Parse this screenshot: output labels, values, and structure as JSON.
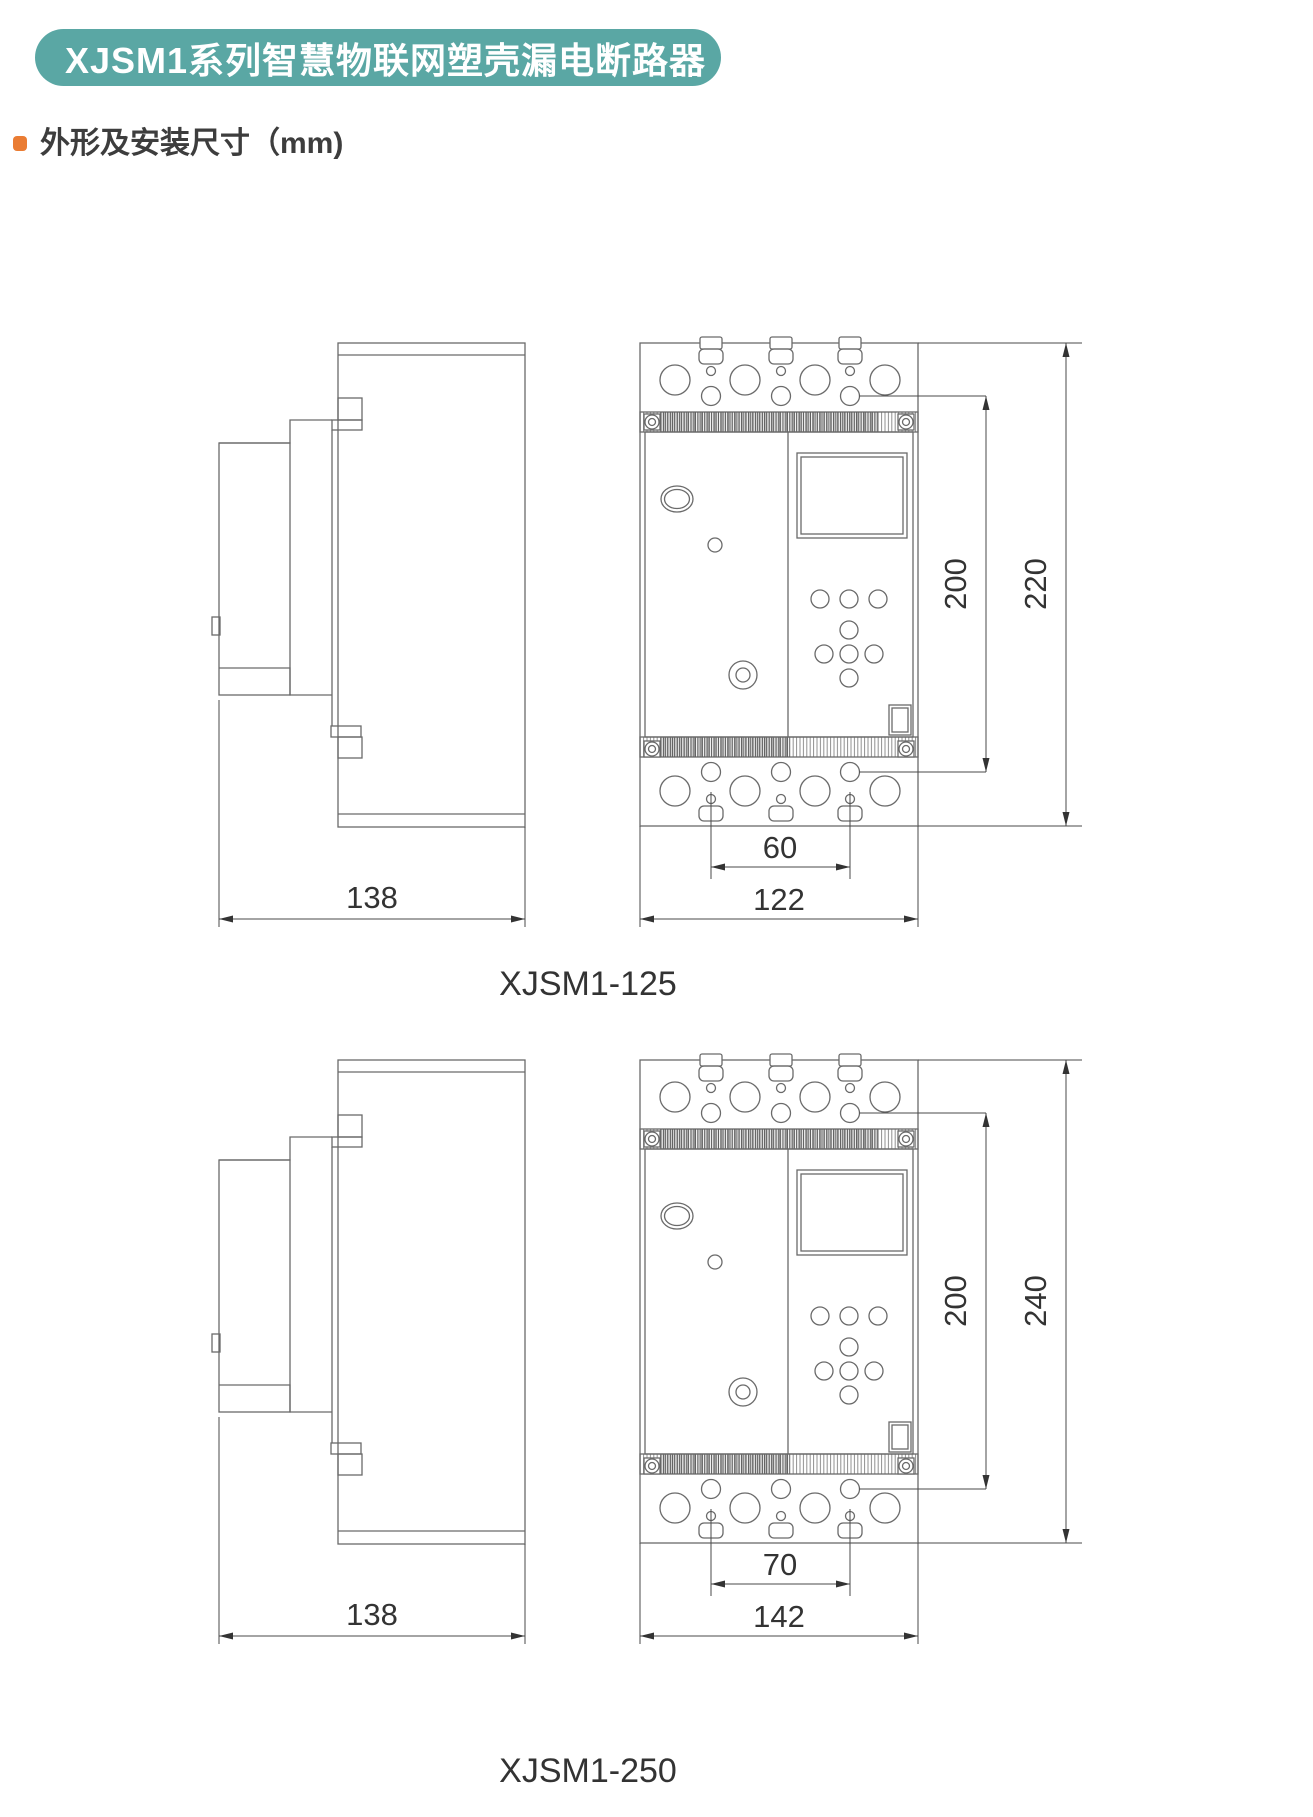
{
  "banner": {
    "title": "XJSM1系列智慧物联网塑壳漏电断路器",
    "bg_color": "#5AA7A4",
    "text_color": "#ffffff"
  },
  "section": {
    "title": "外形及安装尺寸（mm)",
    "bullet_color": "#EA7C33"
  },
  "figures": [
    {
      "caption": "XJSM1-125",
      "dims": {
        "side_width": "138",
        "hole_spacing": "60",
        "body_width": "122",
        "mount_height": "200",
        "body_height": "220"
      }
    },
    {
      "caption": "XJSM1-250",
      "dims": {
        "side_width": "138",
        "hole_spacing": "70",
        "body_width": "142",
        "mount_height": "200",
        "body_height": "240"
      }
    }
  ],
  "drawing_style": {
    "line_color": "#6a6a6a",
    "dim_text_color": "#333333"
  }
}
